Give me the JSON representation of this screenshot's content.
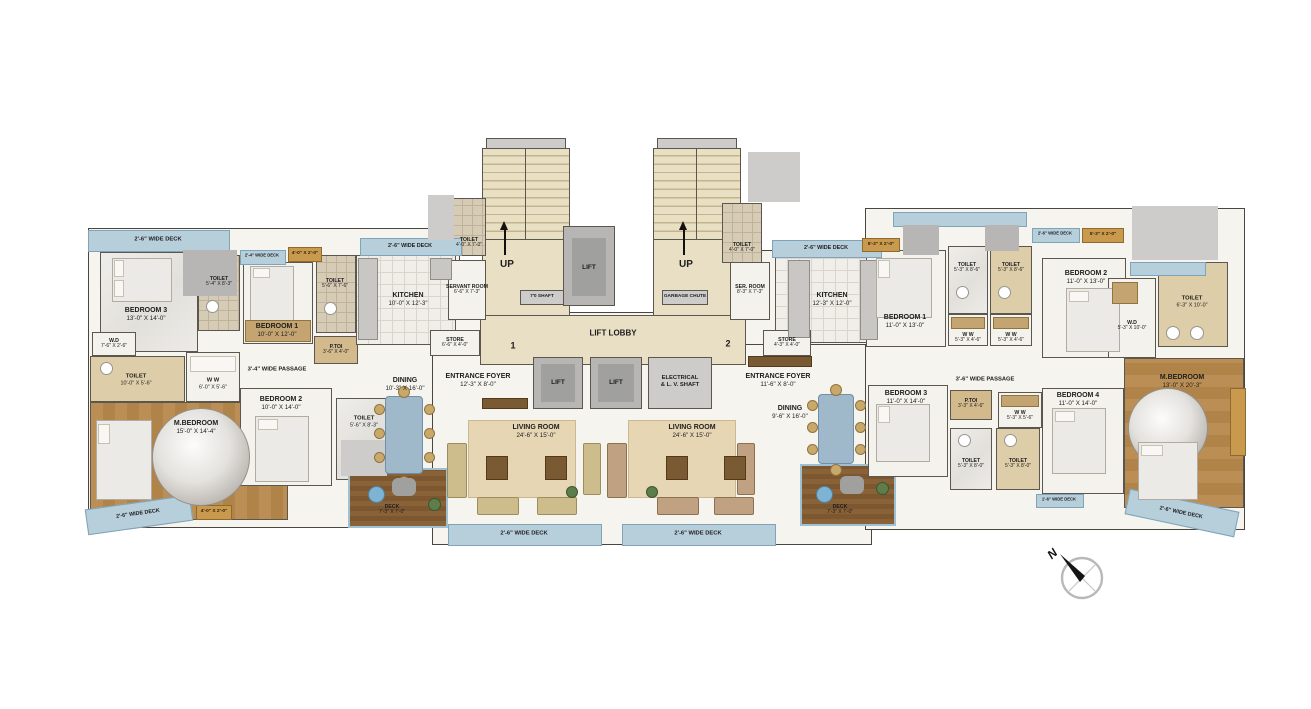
{
  "core": {
    "up": "UP",
    "lift": "LIFT",
    "lift_lobby": "LIFT LOBBY",
    "shaft": "7'0 SHAFT",
    "garbage": "GARBAGE CHUTE",
    "electrical1": "ELECTRICAL",
    "electrical2": "& L. V. SHAFT",
    "unit1": "1",
    "unit2": "2",
    "stair_toilet": {
      "name": "TOILET",
      "dims": "4'-0\" X 7'-0\""
    }
  },
  "unit_left": {
    "bedroom3": {
      "name": "BEDROOM 3",
      "dims": "13'-0\" X 14'-0\""
    },
    "toilet_bed3": {
      "name": "TOILET",
      "dims": "5'-4\" X 8'-3\""
    },
    "bedroom1": {
      "name": "BEDROOM 1",
      "dims": "10'-0\" X 12'-0\""
    },
    "toilet_bed1": {
      "name": "TOILET",
      "dims": "5'-6\" X 7'-6\""
    },
    "p_toi": {
      "name": "P.TOI",
      "dims": "3'-6\" X 4'-0\""
    },
    "wd": {
      "name": "W.D",
      "dims": "7'-6\" X 2'-6\""
    },
    "toilet_m": {
      "name": "TOILET",
      "dims": "10'-0\" X 5'-6\""
    },
    "ww": {
      "name": "W W",
      "dims": "6'-0\" X 5'-6\""
    },
    "passage": "3'-4\" WIDE PASSAGE",
    "m_bedroom": {
      "name": "M.BEDROOM",
      "dims": "15'-0\" X 14'-4\""
    },
    "bedroom2": {
      "name": "BEDROOM 2",
      "dims": "10'-0\" X 14'-0\""
    },
    "toilet_bed2": {
      "name": "TOILET",
      "dims": "5'-6\" X 8'-3\""
    },
    "kitchen": {
      "name": "KITCHEN",
      "dims": "10'-0\" X 12'-3\""
    },
    "servant": {
      "name": "SERVANT ROOM",
      "dims": "6'-6\" X 7'-3\""
    },
    "store": {
      "name": "STORE",
      "dims": "6'-6\" X 4'-0\""
    },
    "dining": {
      "name": "DINING",
      "dims": "10'-3\" X 16'-0\""
    },
    "foyer": {
      "name": "ENTRANCE FOYER",
      "dims": "12'-3\" X 8'-0\""
    },
    "living": {
      "name": "LIVING ROOM",
      "dims": "24'-6\" X 15'-0\""
    },
    "deck": {
      "name": "DECK",
      "dims": "7'-3\" X 7'-0\""
    }
  },
  "unit_right": {
    "kitchen": {
      "name": "KITCHEN",
      "dims": "12'-3\" X 12'-0\""
    },
    "ser_room": {
      "name": "SER. ROOM",
      "dims": "8'-3\" X 7'-3\""
    },
    "store": {
      "name": "STORE",
      "dims": "4'-3\" X 4'-0\""
    },
    "dining": {
      "name": "DINING",
      "dims": "9'-6\" X 16'-0\""
    },
    "foyer": {
      "name": "ENTRANCE FOYER",
      "dims": "11'-6\" X 8'-0\""
    },
    "living": {
      "name": "LIVING ROOM",
      "dims": "24'-6\" X 15'-0\""
    },
    "deck": {
      "name": "DECK",
      "dims": "7'-3\" X 7'-0\""
    },
    "bedroom1": {
      "name": "BEDROOM 1",
      "dims": "11'-0\" X 13'-0\""
    },
    "toilet_a": {
      "name": "TOILET",
      "dims": "5'-3\" X 8'-6\""
    },
    "toilet_b": {
      "name": "TOILET",
      "dims": "5'-3\" X 8'-6\""
    },
    "ww_a": {
      "name": "W W",
      "dims": "5'-3\" X 4'-6\""
    },
    "ww_b": {
      "name": "W W",
      "dims": "5'-3\" X 4'-6\""
    },
    "bedroom2": {
      "name": "BEDROOM 2",
      "dims": "11'-0\" X 13'-0\""
    },
    "toilet_m": {
      "name": "TOILET",
      "dims": "6'-3\" X 10'-0\""
    },
    "wd": {
      "name": "W.D",
      "dims": "5'-3\" X 10'-0\""
    },
    "passage": "3'-6\" WIDE PASSAGE",
    "bedroom3": {
      "name": "BEDROOM 3",
      "dims": "11'-0\" X 14'-0\""
    },
    "p_toi": {
      "name": "P.TOI",
      "dims": "3'-3\" X 4'-6\""
    },
    "ww_c": {
      "name": "W W",
      "dims": "5'-3\" X 5'-6\""
    },
    "toilet_c": {
      "name": "TOILET",
      "dims": "5'-3\" X 8'-0\""
    },
    "toilet_d": {
      "name": "TOILET",
      "dims": "5'-3\" X 8'-0\""
    },
    "bedroom4": {
      "name": "BEDROOM 4",
      "dims": "11'-0\" X 14'-0\""
    },
    "m_bedroom": {
      "name": "M.BEDROOM",
      "dims": "13'-0\" X 20'-3\""
    }
  },
  "decks": {
    "d26": "2'-6\" WIDE DECK",
    "d24": "2'-4\" WIDE DECK",
    "d16": "1'-6\" WIDE DECK"
  },
  "chips": {
    "a": "4'-0\" X 2'-0\"",
    "b": "5'-3\" X 2'-0\""
  },
  "compass": {
    "north": "N"
  }
}
